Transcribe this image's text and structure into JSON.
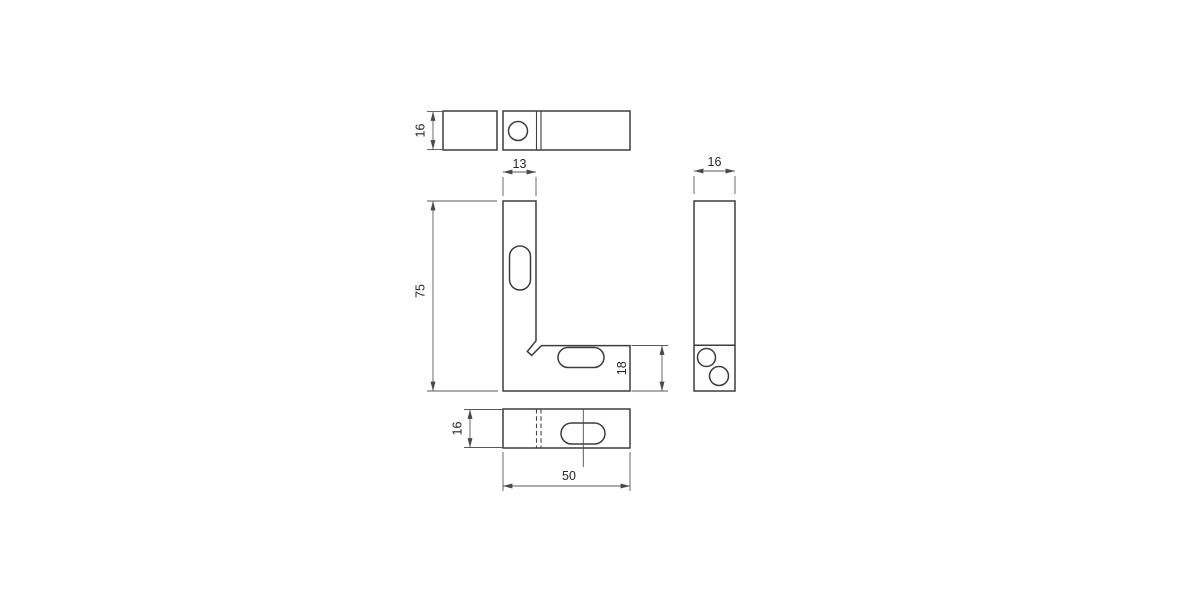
{
  "views": {
    "top": {
      "dim_depth": "16"
    },
    "front": {
      "dim_leg_width": "13",
      "dim_height": "75",
      "dim_foot_height": "18"
    },
    "side": {
      "dim_width": "16"
    },
    "bottom": {
      "dim_depth": "16",
      "dim_length": "50"
    }
  },
  "colors": {
    "background": "#ffffff",
    "object_line": "#3d3d3d",
    "dimension_line": "#575757",
    "text": "#262626"
  }
}
